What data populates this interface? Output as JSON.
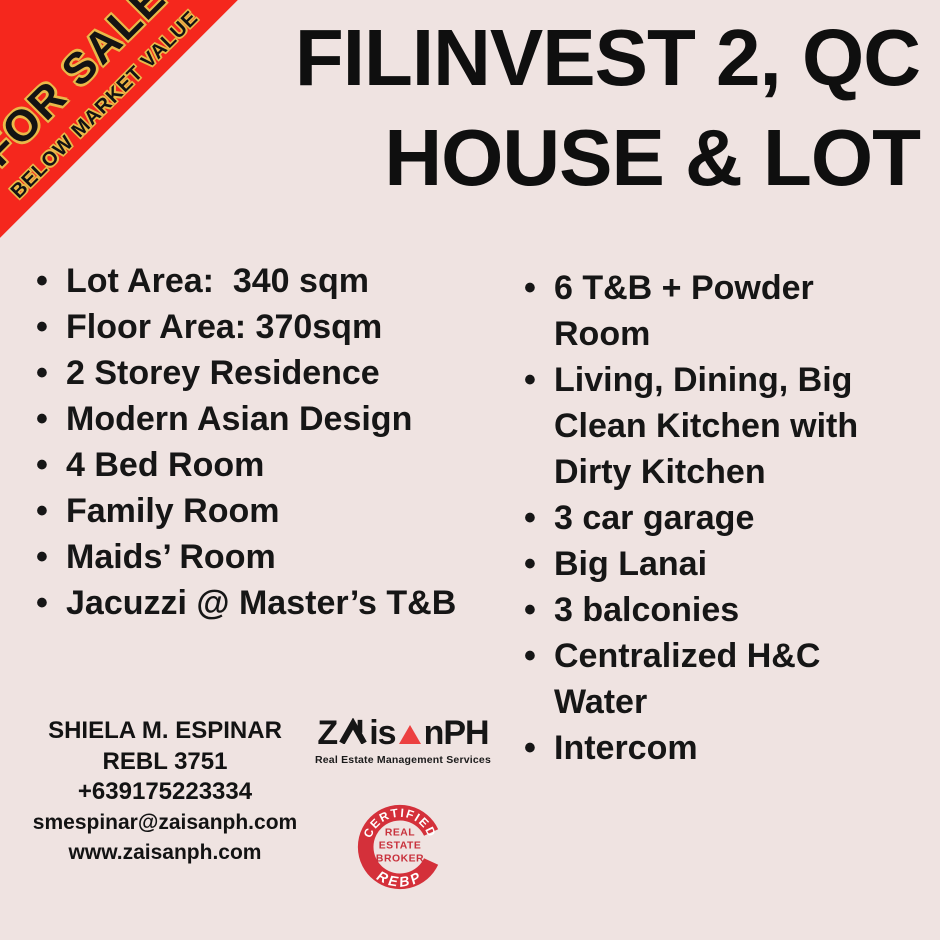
{
  "page": {
    "background_color": "#EFE3E1"
  },
  "ribbon": {
    "line1": "FOR SALE",
    "line2": "BELOW MARKET VALUE",
    "band_color": "#F5271D",
    "text_color": "#131313",
    "outline_color": "#E9B949"
  },
  "title": {
    "line1": "FILINVEST 2, QC",
    "line2": "HOUSE & LOT"
  },
  "glyphs": {
    "bullet": "•"
  },
  "features": {
    "left": [
      "Lot Area:  340 sqm",
      "Floor Area: 370sqm",
      "2 Storey Residence",
      "Modern Asian Design",
      "4 Bed Room",
      "Family Room",
      "Maids’ Room",
      "Jacuzzi @ Master’s T&B"
    ],
    "right": [
      "6 T&B + Powder\nRoom",
      "Living, Dining, Big\nClean Kitchen with\nDirty Kitchen",
      "3 car garage",
      "Big Lanai",
      "3 balconies",
      "Centralized H&C\nWater",
      "Intercom"
    ]
  },
  "contact": {
    "name": "SHIELA M. ESPINAR",
    "license": "REBL 3751",
    "phone": "+639175223334",
    "email": "smespinar@zaisanph.com",
    "website": "www.zaisanph.com"
  },
  "logo": {
    "word_prefix": "Z",
    "word_mid": "is",
    "word_suffix": "nPH",
    "tagline": "Real Estate Management Services",
    "triangle_color": "#EC4040",
    "icons": [
      "house-roof-icon",
      "red-triangle-icon"
    ]
  },
  "badge": {
    "top_text": "CERTIFIED",
    "center_lines": [
      "REAL",
      "ESTATE",
      "BROKER"
    ],
    "bottom_text": "REBP",
    "color": "#D4303A"
  }
}
